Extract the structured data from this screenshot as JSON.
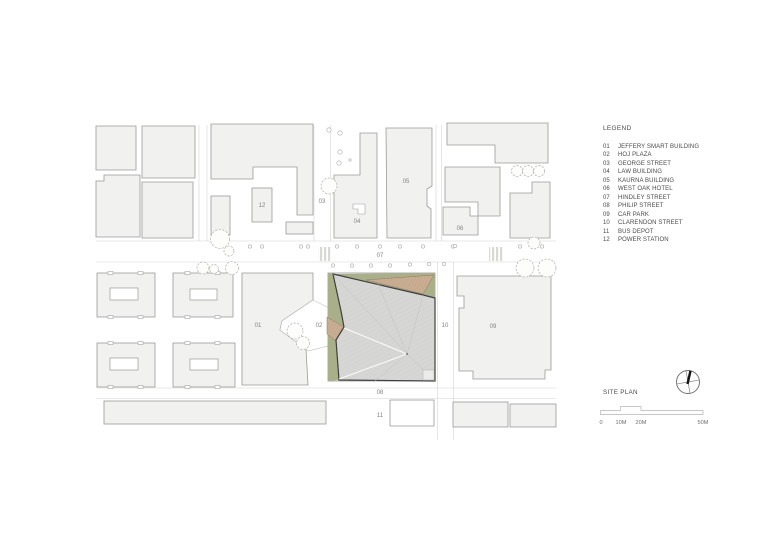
{
  "legend": {
    "title": "LEGEND",
    "items": [
      {
        "id": "01",
        "label": "JEFFERY SMART BUILDING"
      },
      {
        "id": "02",
        "label": "HOJ PLAZA"
      },
      {
        "id": "03",
        "label": "GEORGE STREET"
      },
      {
        "id": "04",
        "label": "LAW BUILDING"
      },
      {
        "id": "05",
        "label": "KAURNA BUILDING"
      },
      {
        "id": "06",
        "label": "WEST OAK HOTEL"
      },
      {
        "id": "07",
        "label": "HINDLEY STREET"
      },
      {
        "id": "08",
        "label": "PHILIP STREET"
      },
      {
        "id": "09",
        "label": "CAR PARK"
      },
      {
        "id": "10",
        "label": "CLARENDON STREET"
      },
      {
        "id": "11",
        "label": "BUS DEPOT"
      },
      {
        "id": "12",
        "label": "POWER STATION"
      }
    ]
  },
  "plan_title": "SITE PLAN",
  "scale_bar": {
    "labels": [
      "0",
      "10M",
      "20M",
      "50M"
    ]
  },
  "colors": {
    "grass": "#a9af88",
    "timber": "#c9ae93",
    "timber_stripe": "#b59878",
    "roof": "#d6d6d4",
    "roof_line": "#cbcbc9",
    "roof_outline": "#3f3f3d",
    "building_fill": "#f1f1ef",
    "building_stroke": "#9b9b99"
  }
}
